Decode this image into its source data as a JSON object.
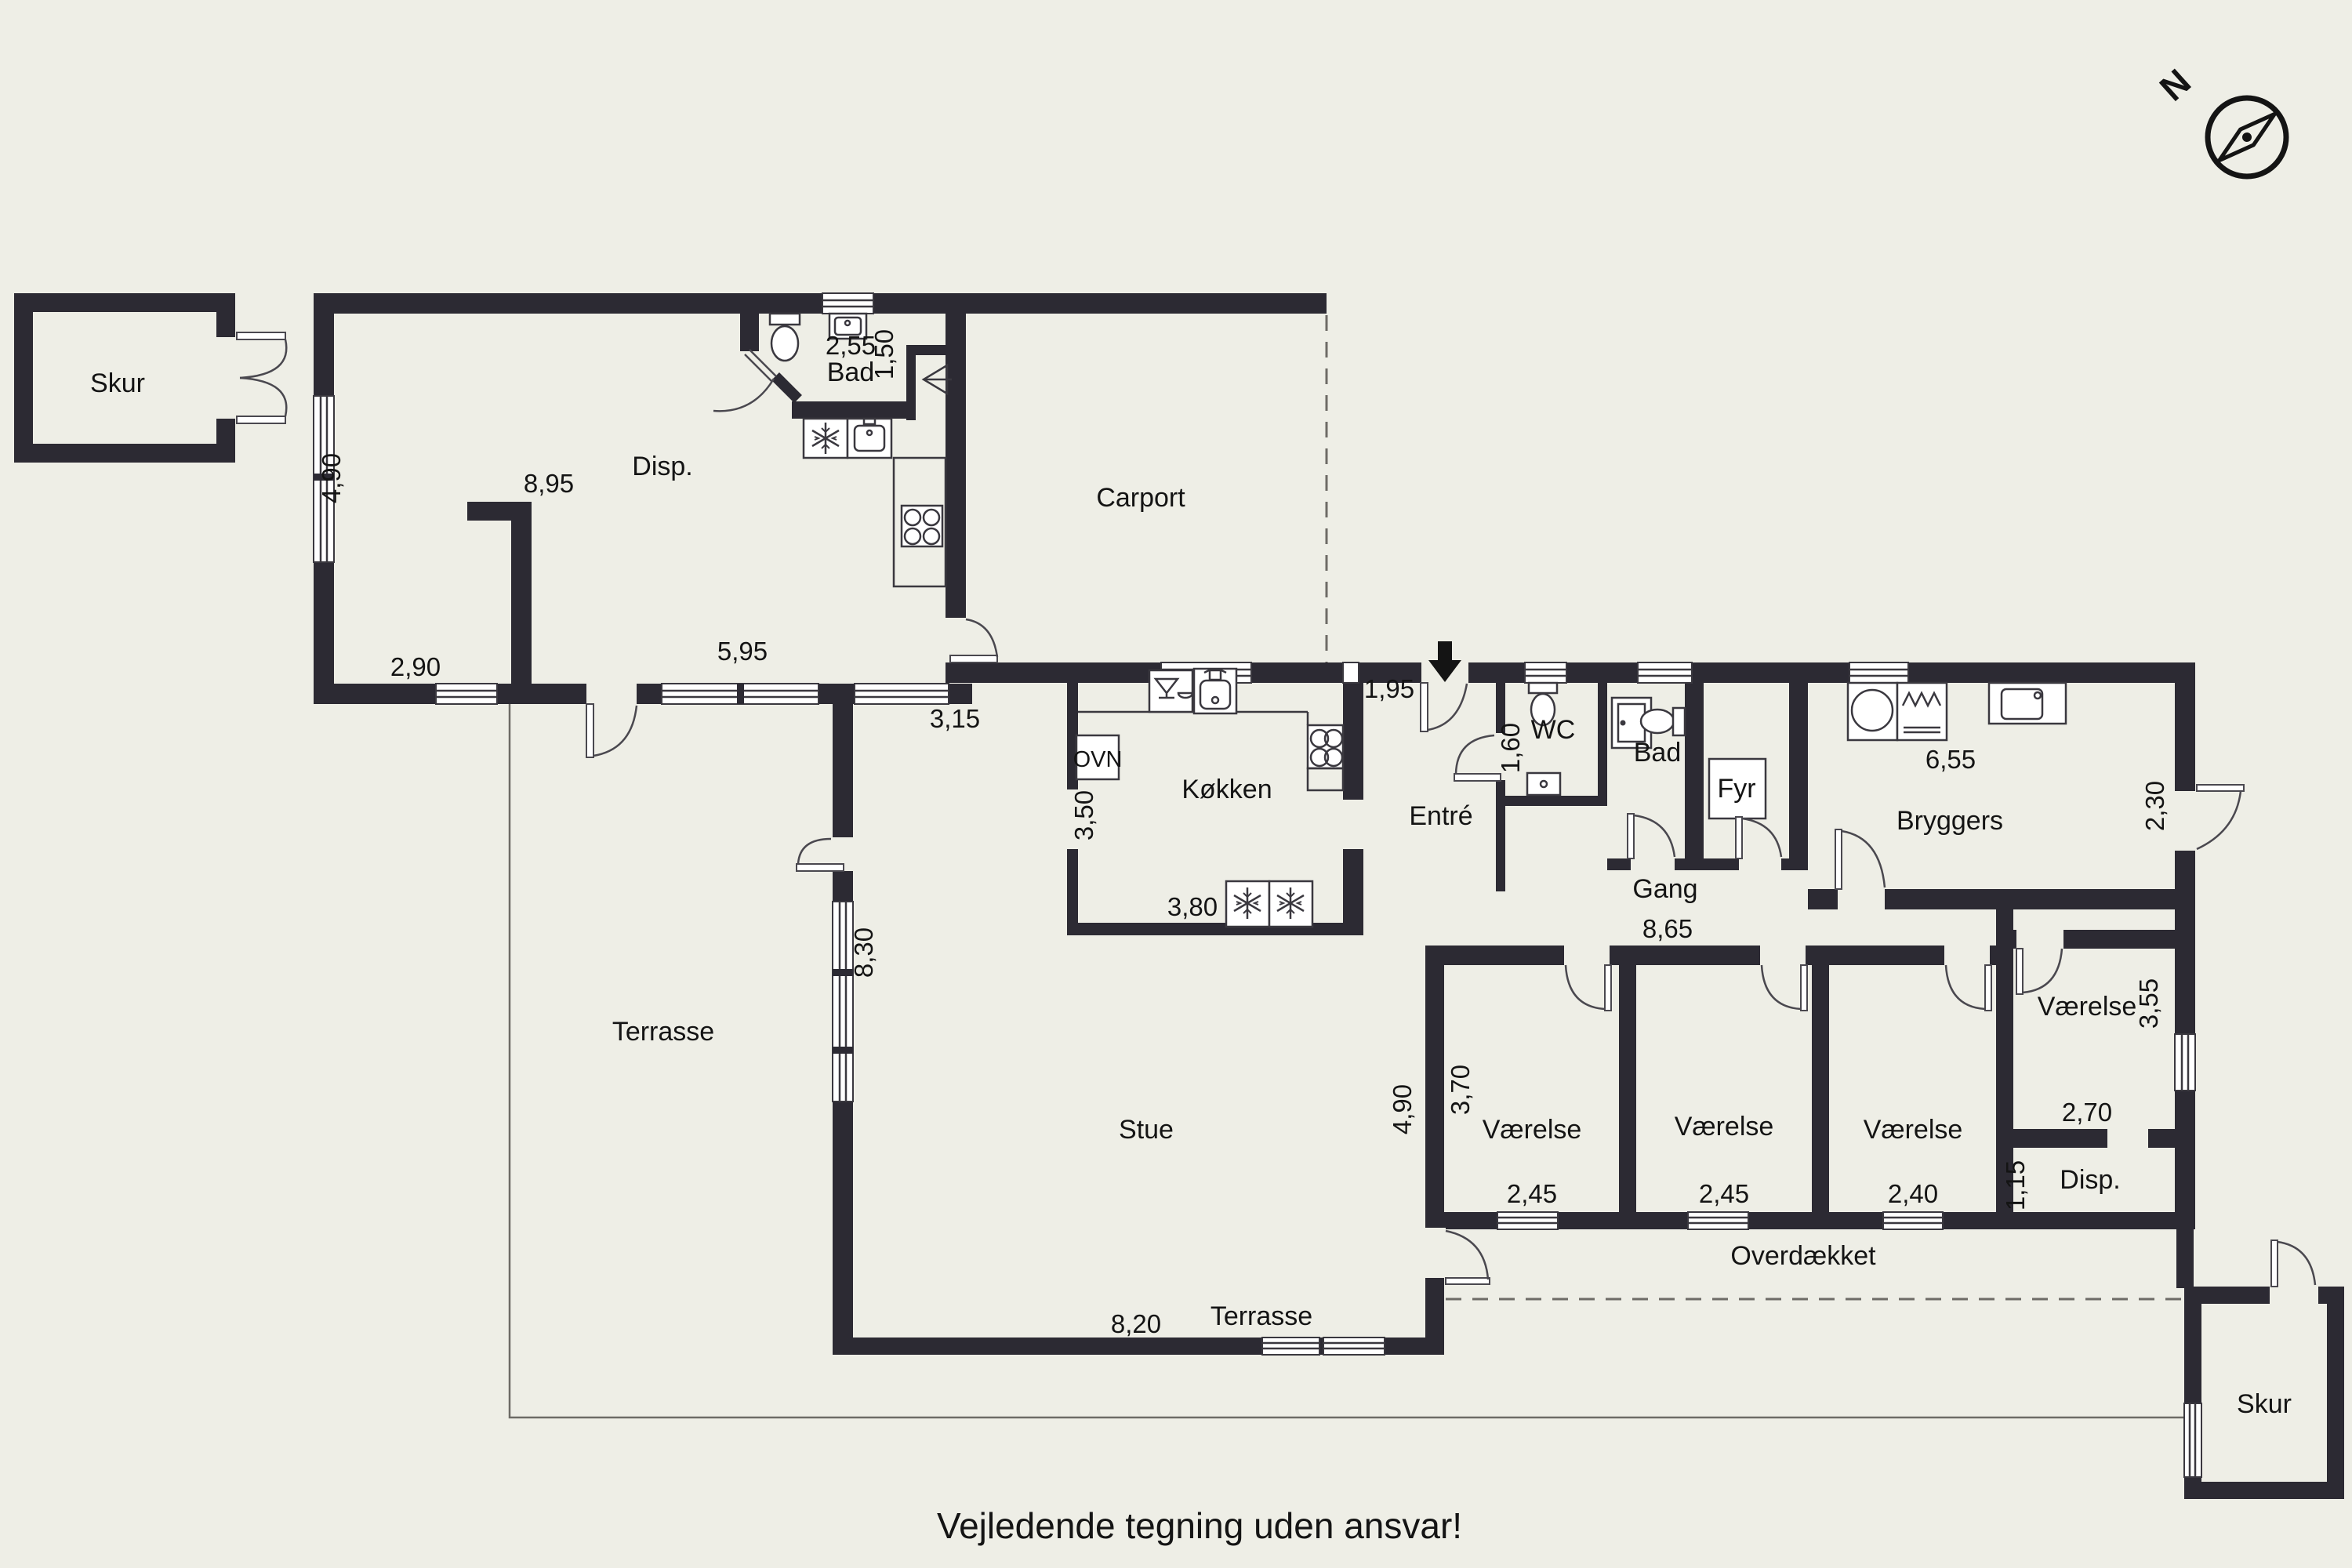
{
  "title": "Vejledende tegning uden ansvar!",
  "compass": {
    "north_label": "N"
  },
  "rooms": {
    "skur_nw": "Skur",
    "disp_upper": "Disp.",
    "bad_upper": "Bad",
    "carport": "Carport",
    "kokken": "Køkken",
    "ovn": "OVN",
    "entre": "Entré",
    "wc": "WC",
    "bad": "Bad",
    "fyr": "Fyr",
    "bryggers": "Bryggers",
    "gang": "Gang",
    "stue": "Stue",
    "terrasse_west": "Terrasse",
    "terrasse_south": "Terrasse",
    "vaerelse_1": "Værelse",
    "vaerelse_2": "Værelse",
    "vaerelse_3": "Værelse",
    "vaerelse_4": "Værelse",
    "disp_se": "Disp.",
    "overdaekket": "Overdækket",
    "skur_se": "Skur"
  },
  "dims": {
    "d490_nw": "4,90",
    "d290": "2,90",
    "d895": "8,95",
    "d255": "2,55",
    "d150": "1,50",
    "d595": "5,95",
    "d315": "3,15",
    "d195": "1,95",
    "d350": "3,50",
    "d380": "3,80",
    "d160": "1,60",
    "d655": "6,55",
    "d230": "2,30",
    "d865": "8,65",
    "d830": "8,30",
    "d820": "8,20",
    "d490_stue": "4,90",
    "d370": "3,70",
    "d245_1": "2,45",
    "d245_2": "2,45",
    "d240": "2,40",
    "d355": "3,55",
    "d270": "2,70",
    "d115": "1,15"
  }
}
